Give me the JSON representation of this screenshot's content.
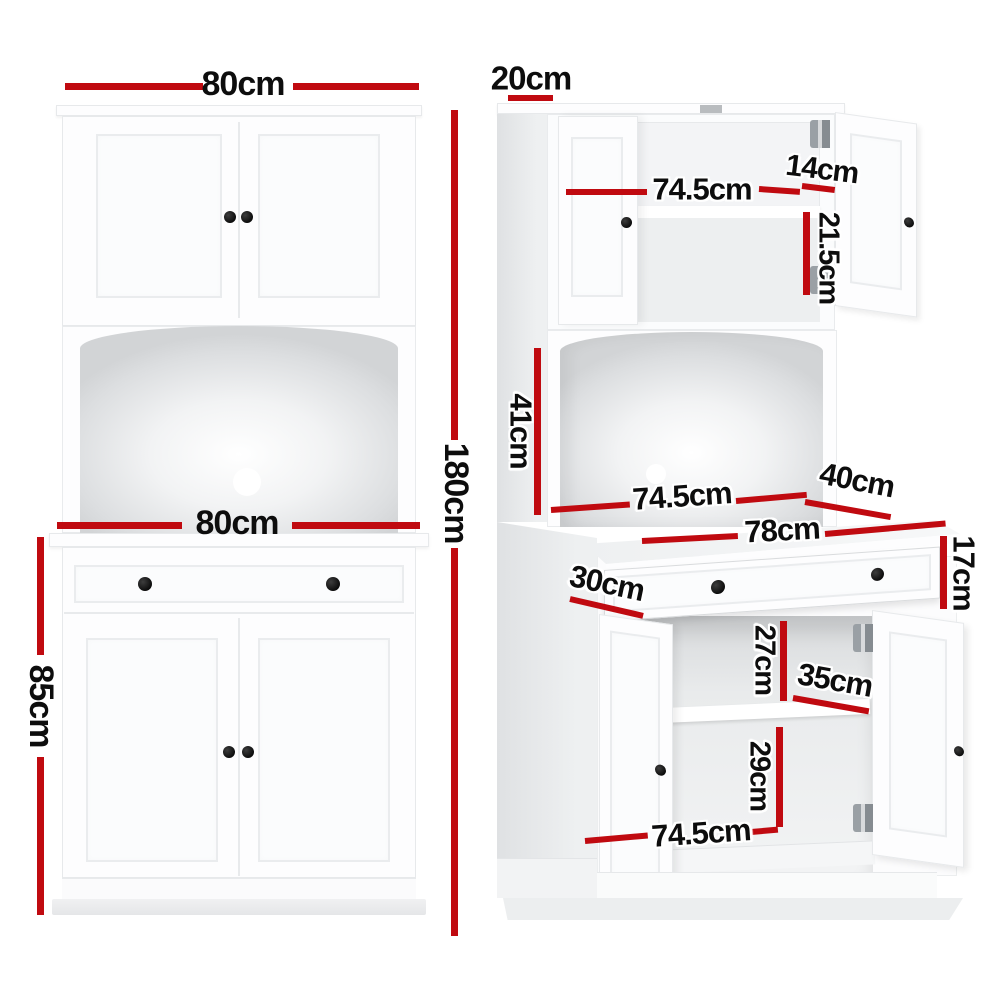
{
  "page": {
    "background": "#ffffff",
    "accent_color": "#c00a10",
    "label_color": "#0d0d0d",
    "unit": "cm"
  },
  "front_view": {
    "dims": {
      "hutch_width": "80cm",
      "overall_height": "180cm",
      "cabinet_width": "80cm",
      "cabinet_height": "85cm"
    }
  },
  "open_view": {
    "dims": {
      "hutch_depth": "20cm",
      "hutch_opening_width": "74.5cm",
      "door_clearance": "14cm",
      "hutch_opening_height": "21.5cm",
      "niche_height": "41cm",
      "niche_width": "74.5cm",
      "benchtop_depth": "40cm",
      "drawer_width": "78cm",
      "drawer_height": "17cm",
      "drawer_depth": "30cm",
      "shelf_space_top": "27cm",
      "shelf_depth": "35cm",
      "shelf_space_bottom": "29cm",
      "cabinet_opening_width": "74.5cm"
    }
  }
}
